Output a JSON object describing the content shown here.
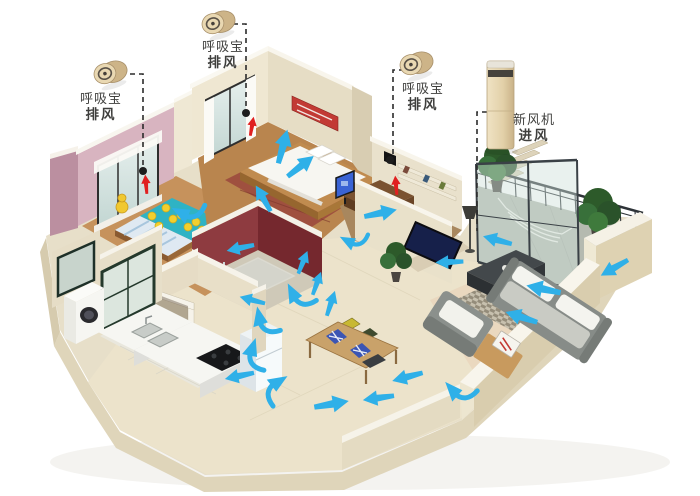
{
  "callouts": [
    {
      "device": "exhaust-fan-child-bedroom",
      "line1": "呼吸宝",
      "line2": "排风"
    },
    {
      "device": "exhaust-fan-master-bedroom",
      "line1": "呼吸宝",
      "line2": "排风"
    },
    {
      "device": "exhaust-fan-study",
      "line1": "呼吸宝",
      "line2": "排风"
    },
    {
      "device": "fresh-air-unit-living-room",
      "line1": "新风机",
      "line2": "进风"
    }
  ],
  "colors": {
    "airflow": "#2fb0e8",
    "exhaust": "#e02020",
    "leader": "#2b2b2b",
    "vent": "#1d1d1d",
    "device_gold": "#e9d8b2",
    "label_text": "#3f3f3d",
    "wall_cream": "#ece4cf",
    "wall_pink": "#d8b4c0",
    "wall_maroon": "#8e3b40"
  },
  "devices": {
    "puck_transforms": [
      "translate(110,73) rotate(-18)",
      "translate(218,23) rotate(-18)",
      "translate(416,64) rotate(-18)"
    ],
    "tower_transform": "translate(501,105)"
  },
  "vents": [
    {
      "x": 143,
      "y": 171
    },
    {
      "x": 246,
      "y": 113
    },
    {
      "x": 390,
      "y": 160
    }
  ],
  "leaders": [
    "M130,74 L143,74 L143,166",
    "M233,24 L246,24 L246,108",
    "M404,70 L393,70 L393,155",
    "M487,112 L477,112 L477,231"
  ],
  "exhaust_arrows": [
    {
      "x": 146,
      "y": 184,
      "rot": -95,
      "s": 0.55
    },
    {
      "x": 252,
      "y": 126,
      "rot": -80,
      "s": 0.55
    },
    {
      "x": 396,
      "y": 185,
      "rot": -95,
      "s": 0.55
    }
  ],
  "airflow": {
    "arrows": [
      {
        "x": 283,
        "y": 146,
        "rot": -75,
        "s": 1,
        "t": "s"
      },
      {
        "x": 301,
        "y": 166,
        "rot": -38,
        "s": 0.95,
        "t": "s"
      },
      {
        "x": 263,
        "y": 198,
        "rot": -120,
        "s": 0.85,
        "t": "s"
      },
      {
        "x": 186,
        "y": 207,
        "rot": -127,
        "s": 1,
        "t": "c"
      },
      {
        "x": 240,
        "y": 248,
        "rot": 168,
        "s": 0.8,
        "t": "s"
      },
      {
        "x": 381,
        "y": 213,
        "rot": -12,
        "s": 0.95,
        "t": "s"
      },
      {
        "x": 352,
        "y": 236,
        "rot": -127,
        "s": 0.85,
        "t": "c"
      },
      {
        "x": 303,
        "y": 262,
        "rot": -68,
        "s": 0.7,
        "t": "s"
      },
      {
        "x": 317,
        "y": 283,
        "rot": -70,
        "s": 0.7,
        "t": "s"
      },
      {
        "x": 331,
        "y": 303,
        "rot": -72,
        "s": 0.75,
        "t": "s"
      },
      {
        "x": 300,
        "y": 291,
        "rot": -92,
        "s": 1,
        "t": "c"
      },
      {
        "x": 267,
        "y": 317,
        "rot": -77,
        "s": 1,
        "t": "c"
      },
      {
        "x": 259,
        "y": 352,
        "rot": -47,
        "s": 1,
        "t": "c"
      },
      {
        "x": 281,
        "y": 389,
        "rot": -7,
        "s": 1,
        "t": "c"
      },
      {
        "x": 332,
        "y": 404,
        "rot": -10,
        "s": 1,
        "t": "s"
      },
      {
        "x": 378,
        "y": 398,
        "rot": 172,
        "s": 0.9,
        "t": "s"
      },
      {
        "x": 407,
        "y": 377,
        "rot": 165,
        "s": 0.9,
        "t": "s"
      },
      {
        "x": 543,
        "y": 289,
        "rot": -168,
        "s": 1,
        "t": "s"
      },
      {
        "x": 521,
        "y": 317,
        "rot": -162,
        "s": 0.95,
        "t": "s"
      },
      {
        "x": 449,
        "y": 262,
        "rot": 178,
        "s": 0.8,
        "t": "s"
      },
      {
        "x": 459,
        "y": 386,
        "rot": -107,
        "s": 1,
        "t": "c"
      },
      {
        "x": 614,
        "y": 268,
        "rot": 150,
        "s": 0.9,
        "t": "s"
      },
      {
        "x": 497,
        "y": 240,
        "rot": -165,
        "s": 0.85,
        "t": "s"
      },
      {
        "x": 239,
        "y": 376,
        "rot": 168,
        "s": 0.85,
        "t": "s"
      },
      {
        "x": 252,
        "y": 300,
        "rot": -165,
        "s": 0.75,
        "t": "s"
      }
    ]
  }
}
